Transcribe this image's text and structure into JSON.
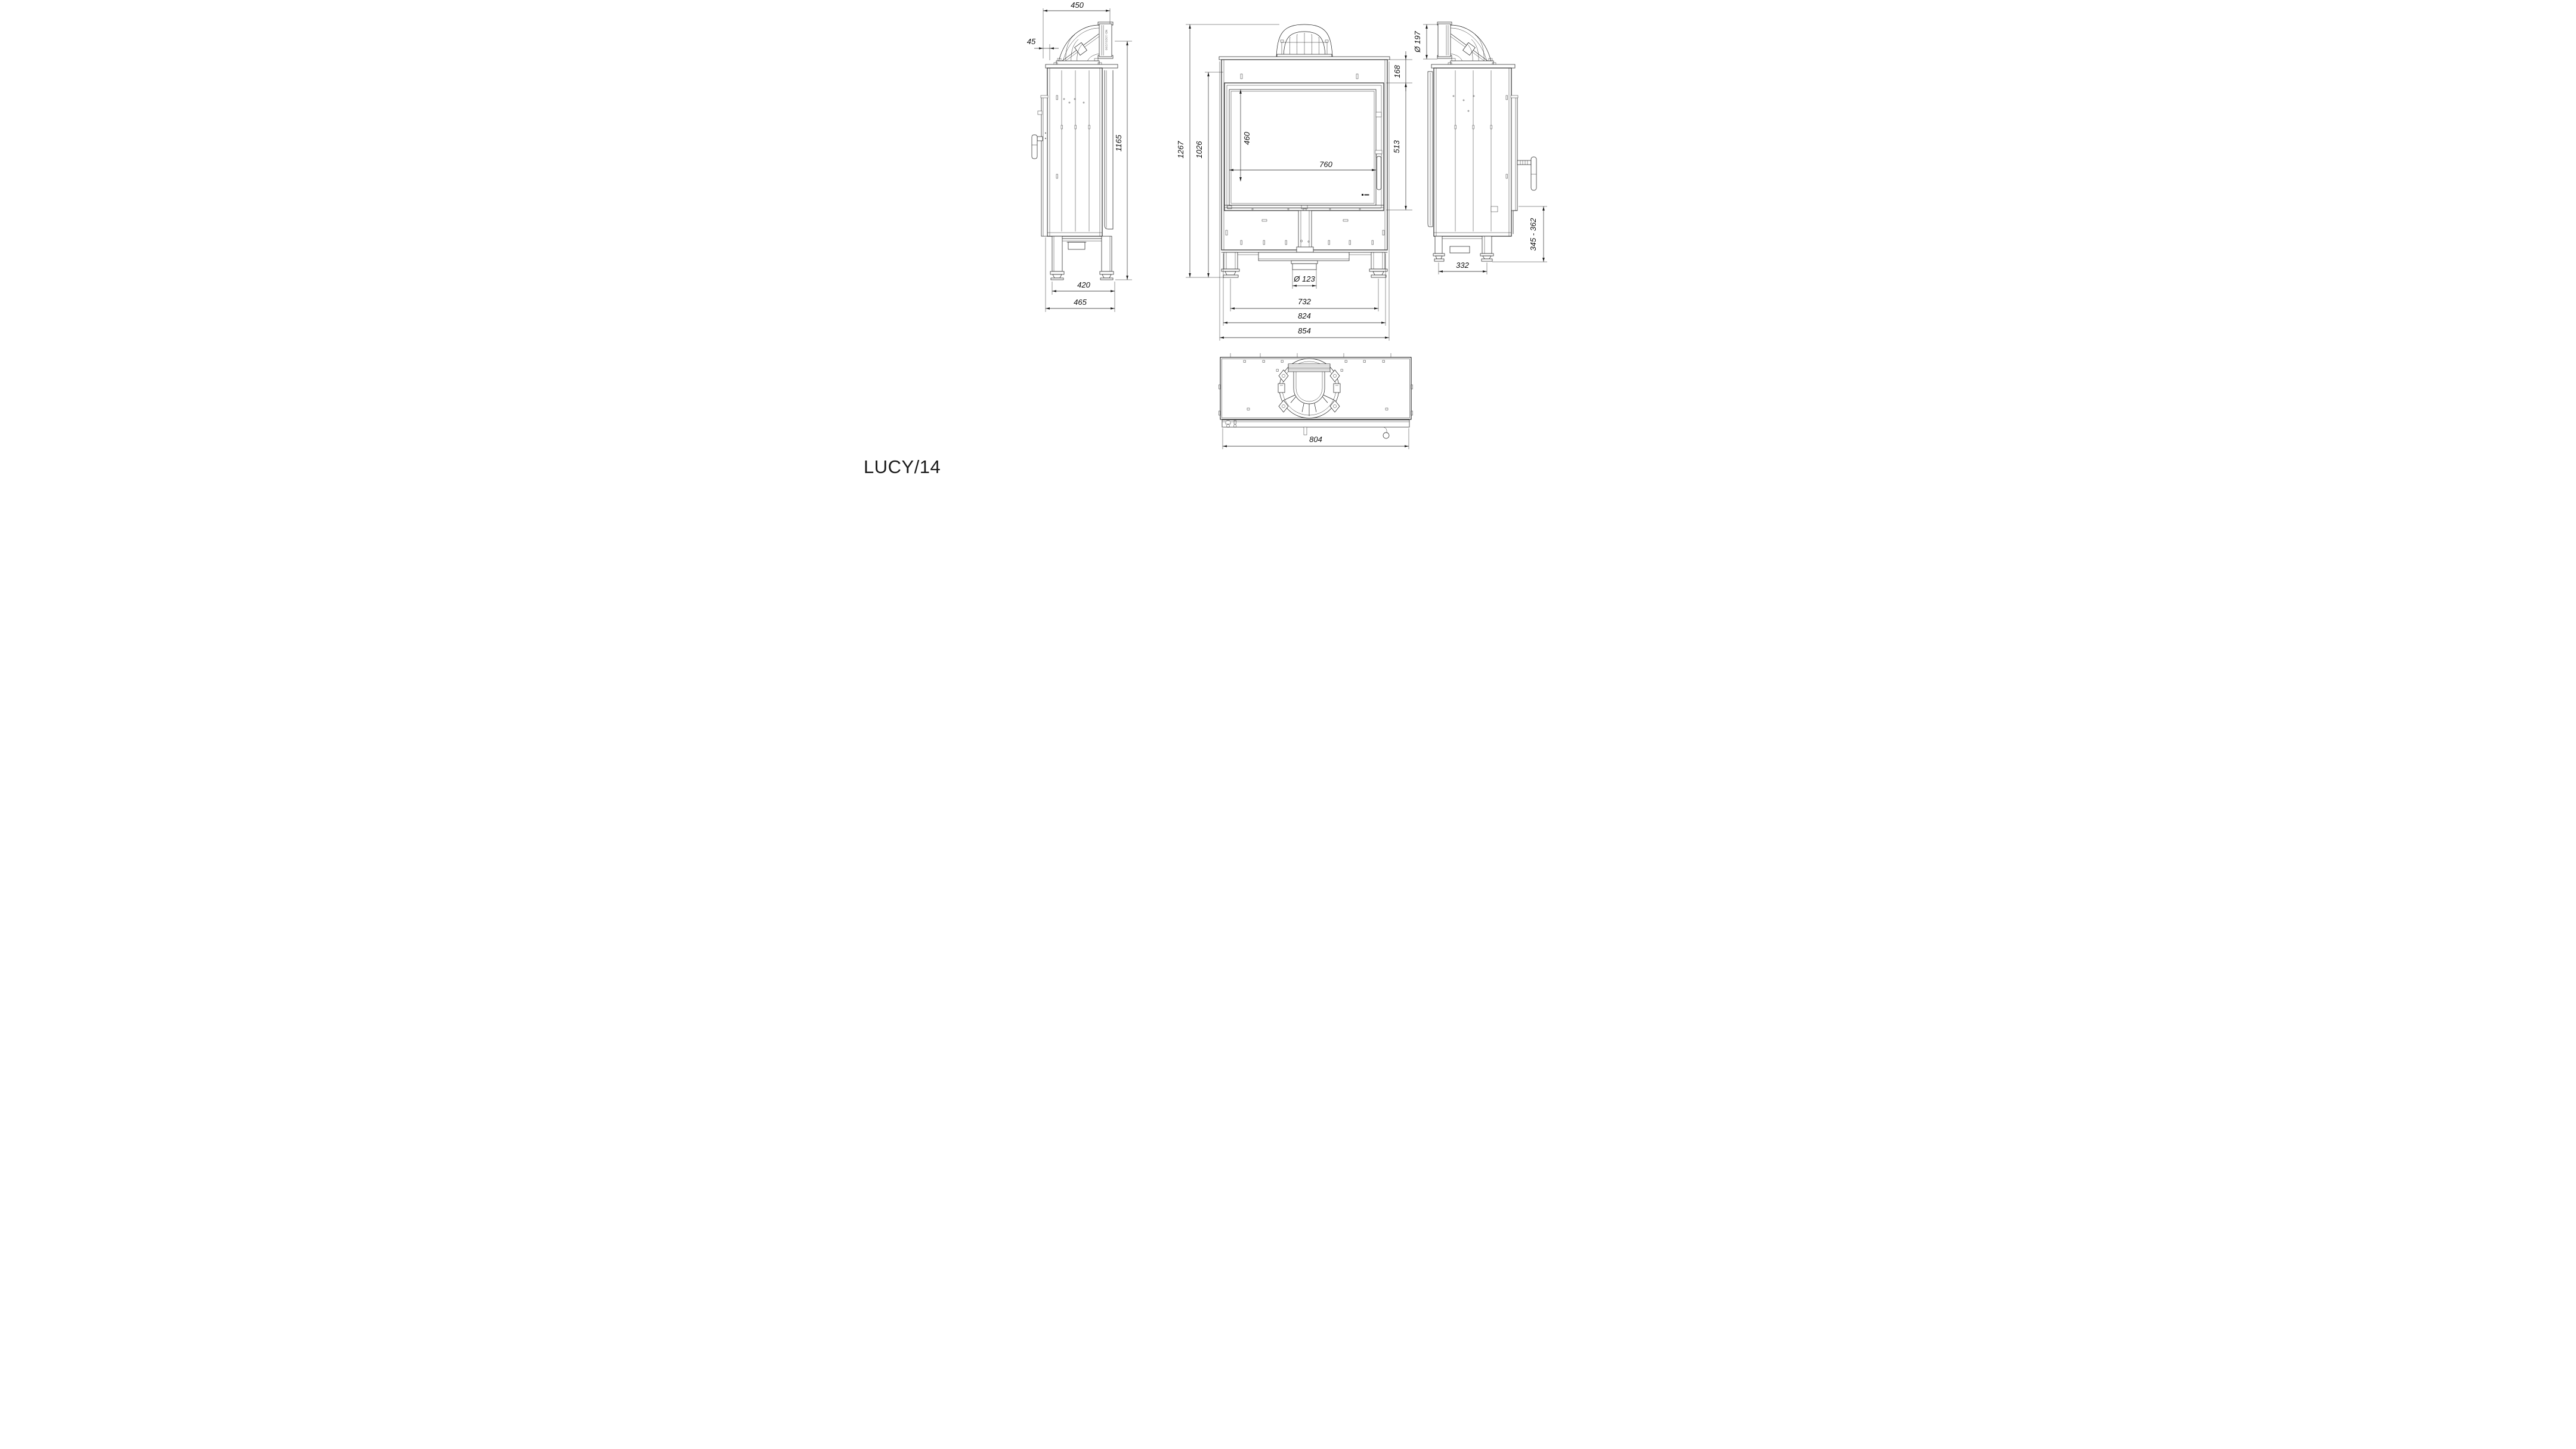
{
  "title": "LUCY/14",
  "elbow_label": "ND-10201/200",
  "left_view": {
    "top_width": "450",
    "front_offset": "45",
    "height": "1165",
    "feet_width": "420",
    "depth": "465"
  },
  "front_view": {
    "total_height": "1267",
    "casing_height": "1026",
    "top_to_glass": "168",
    "glass_height": "460",
    "glass_width": "760",
    "door_height": "513",
    "outlet_dia": "Ø 123",
    "feet_span": "732",
    "base_width": "824",
    "overall_width": "854"
  },
  "right_view": {
    "flue_dia": "Ø 197",
    "base_height": "345 - 362",
    "feet_span": "332"
  },
  "top_view": {
    "width": "804"
  }
}
